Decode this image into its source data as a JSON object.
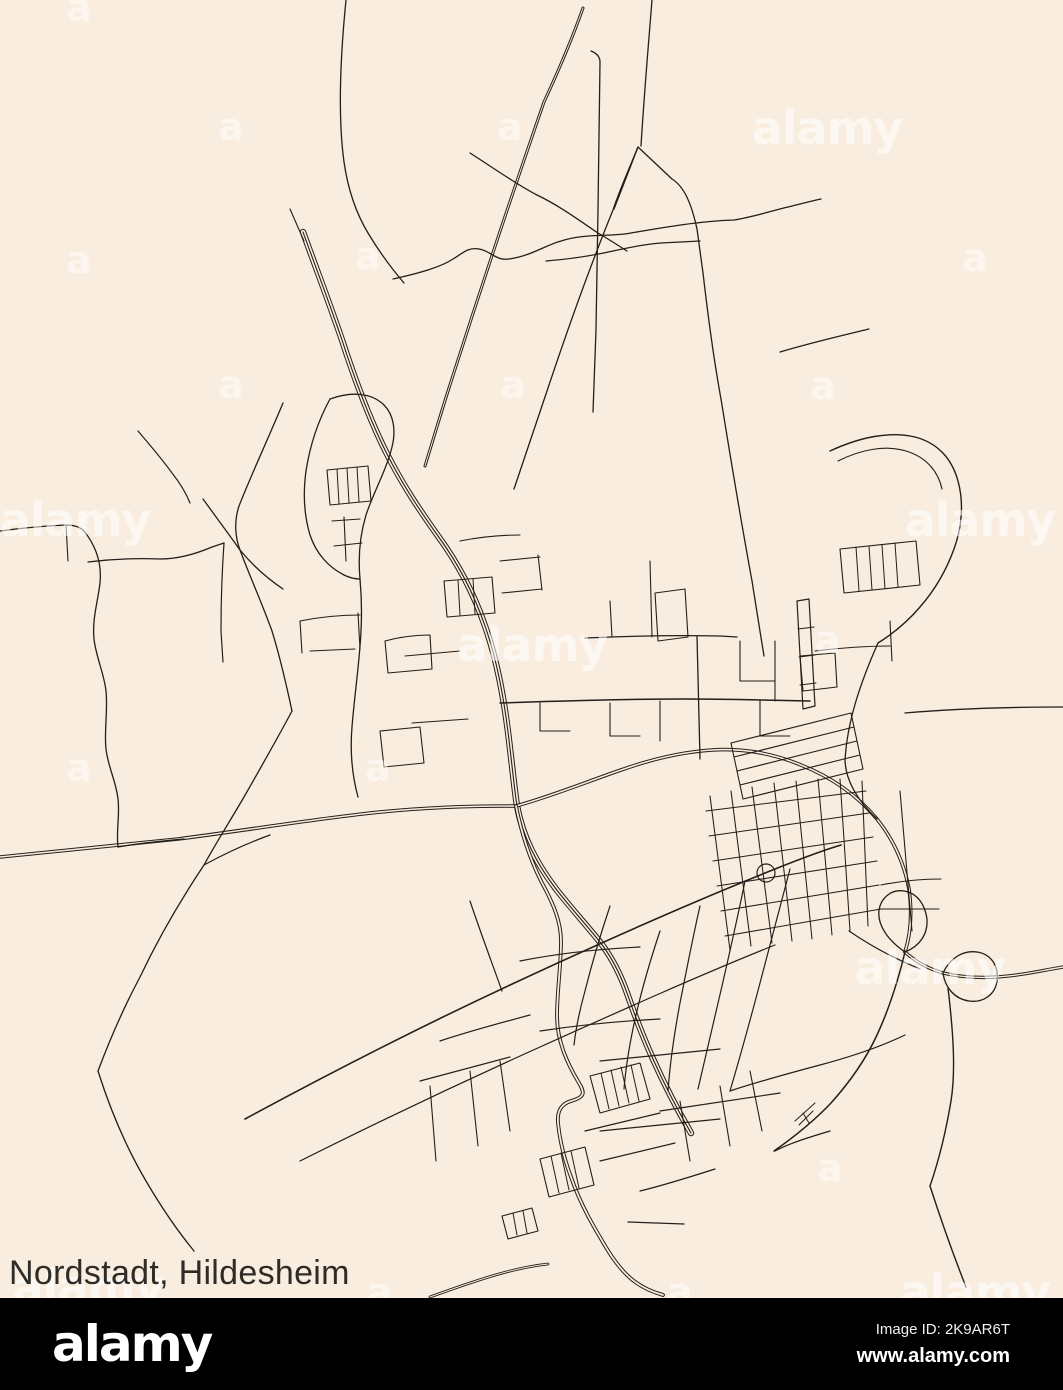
{
  "page": {
    "width": 1063,
    "height": 1390,
    "background": "#f8eddf"
  },
  "caption": {
    "text": "Nordstadt, Hildesheim"
  },
  "footer": {
    "background": "#000000",
    "logo_text": "alamy",
    "image_id": "Image ID: 2K9AR6T",
    "website": "www.alamy.com",
    "text_color": "#ffffff"
  },
  "watermarks": {
    "text": "alamy",
    "letter": "a",
    "color": "#ffffff",
    "logos": [
      {
        "x": 827,
        "y": 128
      },
      {
        "x": 75,
        "y": 520
      },
      {
        "x": 980,
        "y": 520
      },
      {
        "x": 532,
        "y": 645
      },
      {
        "x": 930,
        "y": 968
      },
      {
        "x": 88,
        "y": 1287
      },
      {
        "x": 975,
        "y": 1292
      }
    ],
    "letters": [
      {
        "x": 79,
        "y": 8
      },
      {
        "x": 231,
        "y": 127
      },
      {
        "x": 510,
        "y": 127
      },
      {
        "x": 79,
        "y": 260
      },
      {
        "x": 368,
        "y": 256
      },
      {
        "x": 231,
        "y": 385
      },
      {
        "x": 513,
        "y": 385
      },
      {
        "x": 823,
        "y": 386
      },
      {
        "x": 975,
        "y": 258
      },
      {
        "x": 79,
        "y": 768
      },
      {
        "x": 378,
        "y": 768
      },
      {
        "x": 828,
        "y": 640
      },
      {
        "x": 830,
        "y": 1168
      },
      {
        "x": 680,
        "y": 1292
      },
      {
        "x": 380,
        "y": 1292
      }
    ]
  },
  "map": {
    "title": "Nordstadt, Hildesheim road map",
    "district": "Nordstadt",
    "city": "Hildesheim",
    "road_color": "#241f1a",
    "background_color": "#f8eddf",
    "roads": [
      {
        "d": "M303,232 C316,268 329,302 342,340 C355,380 369,418 386,452 C403,486 421,512 438,536 C457,562 473,591 485,626 C495,654 503,692 508,732 C512,764 514,786 517,806 C523,838 537,864 556,889 C574,912 591,930 603,946 C613,960 621,976 627,993 C635,1016 643,1037 653,1059 C665,1086 677,1109 691,1133",
        "rail": true
      },
      {
        "d": "M0,857 C60,851 120,845 178,839 C240,831 302,821 362,814 C422,807 472,806 516,806",
        "casing": true,
        "w": 3.6
      },
      {
        "d": "M516,806 C552,796 586,782 621,770 C652,759 682,752 712,750 C742,748 772,753 801,765 C831,777 857,795 877,819 C893,839 904,863 909,889 C912,911 911,933 905,952",
        "casing": true,
        "w": 3.6
      },
      {
        "d": "M905,952 C916,962 929,969 943,973 C976,981 1011,977 1046,970 L1063,967",
        "casing": true,
        "w": 3.4
      },
      {
        "d": "M905,952 C898,981 889,1009 877,1035 C865,1061 849,1083 831,1103 C814,1121 794,1137 774,1151",
        "w": 1.5
      },
      {
        "d": "M948,988 C953,1030 956,1070 951,1101 C946,1131 939,1160 930,1186",
        "w": 1.4
      },
      {
        "d": "M930,1186 C941,1220 953,1254 966,1287",
        "w": 1.4
      },
      {
        "d": "M905,952 C889,941 877,926 879,910 C881,898 891,889 904,891 C917,893 925,904 927,919 C928,934 920,946 905,952",
        "w": 1.3
      },
      {
        "d": "M943,973 C950,958 963,950 977,952 C991,954 999,966 997,981 C995,995 983,1003 969,1001 C955,999 945,988 943,973",
        "w": 1.3
      },
      {
        "d": "M516,806 C521,831 529,857 541,881 C553,903 561,921 561,941 C561,966 557,991 557,1016 C557,1041 567,1063 579,1083 C585,1093 585,1097 571,1101 C561,1104 557,1111 558,1123 C560,1143 565,1161 571,1177 C581,1206 595,1229 607,1249 C613,1259 619,1267 627,1275 C637,1285 649,1291 663,1295",
        "casing": true,
        "w": 3.8
      },
      {
        "d": "M628,1222 L684,1224",
        "w": 1.3
      },
      {
        "d": "M430,1297 C452,1289 472,1282 492,1276 C512,1270 530,1266 548,1264",
        "casing": true,
        "w": 2.8
      },
      {
        "d": "M245,1119 C330,1073 420,1027 510,985 C600,943 690,903 775,869 C800,859 821,851 841,845",
        "w": 1.6
      },
      {
        "d": "M583,8 C570,45 557,74 544,102 C517,180 484,278 449,388 C441,413 433,440 425,466",
        "casing": true,
        "w": 3.0
      },
      {
        "d": "M591,51 C596,53 600,56 600,62 L598,210 L596,330 C595,360 594,386 593,412",
        "w": 1.3
      },
      {
        "d": "M652,0 C648,50 644,96 641,146",
        "w": 1.3
      },
      {
        "d": "M614,209 L638,147 L672,179 C685,187 692,206 697,229 L703,273 C708,316 714,361 721,399 C731,461 741,521 752,581 C756,607 760,631 764,656",
        "w": 1.3
      },
      {
        "d": "M638,147 C629,169 620,189 613,210 C589,269 567,331 547,391 C536,423 525,456 514,489",
        "w": 1.3
      },
      {
        "d": "M393,279 C420,273 441,267 453,259 C463,253 468,247 479,249 C491,251 496,261 509,259 C531,256 546,245 561,241 C586,233 611,237 631,233 C666,227 701,221 734,220 C753,217 771,211 788,207 C801,204 811,201 821,199",
        "w": 1.3
      },
      {
        "d": "M546,261 C571,259 591,256 613,251 C631,247 646,244 661,243 L700,241",
        "w": 1.2
      },
      {
        "d": "M780,352 C810,343 840,336 869,329",
        "w": 1.3
      },
      {
        "d": "M346,0 C340,60 338,118 344,162 C348,190 356,213 368,233 C380,253 392,269 404,283",
        "w": 1.3
      },
      {
        "d": "M470,153 C495,169 519,186 537,195 C560,206 580,221 598,233 C610,240 619,246 627,251",
        "w": 1.3
      },
      {
        "d": "M290,209 L304,241",
        "w": 1.1
      },
      {
        "d": "M283,403 C268,439 252,473 239,506 C234,521 235,537 240,550 C250,577 262,603 272,631 C280,657 286,683 292,711",
        "w": 1.3
      },
      {
        "d": "M203,499 C216,517 228,533 240,550 C254,567 268,579 283,589",
        "w": 1.3
      },
      {
        "d": "M88,562 C112,559 136,558 160,559 C180,559 198,553 212,547 L224,543",
        "w": 1.3
      },
      {
        "d": "M224,543 C222,571 221,601 221,631 L223,662",
        "w": 1.2
      },
      {
        "d": "M138,431 C150,445 162,459 172,473 C180,483 186,493 190,503",
        "w": 1.2
      },
      {
        "d": "M0,531 C22,528 44,526 66,525 C74,525 80,527 84,531",
        "w": 1.3
      },
      {
        "d": "M66,525 L68,561",
        "w": 1.1
      },
      {
        "d": "M84,531 C96,546 102,563 100,583 C98,601 92,619 94,639 C96,657 104,673 106,691 C108,711 104,731 106,749 C108,767 116,781 118,799 C120,815 116,831 118,847",
        "w": 1.3
      },
      {
        "d": "M118,847 C140,843 162,841 184,839",
        "w": 1.2
      },
      {
        "d": "M330,399 C352,391 372,393 384,405 C394,415 396,431 392,447 C386,471 374,491 366,515 C360,535 358,557 360,579",
        "w": 1.3
      },
      {
        "d": "M330,399 C318,421 310,445 306,471 C303,493 304,515 310,535 C316,553 328,567 344,575 C352,579 358,579 360,579",
        "w": 1.3
      },
      {
        "d": "M327,470 L368,466 L371,501 L330,505 Z",
        "w": 1.1
      },
      {
        "d": "M337,469 L339,504",
        "w": 1
      },
      {
        "d": "M347,468 L349,503",
        "w": 1
      },
      {
        "d": "M357,467 L359,502",
        "w": 1
      },
      {
        "d": "M332,521 L360,519",
        "w": 1.1
      },
      {
        "d": "M334,546 L362,543",
        "w": 1.1
      },
      {
        "d": "M344,517 L346,561",
        "w": 1.1
      },
      {
        "d": "M360,579 C362,601 362,623 360,646 C358,673 354,701 352,727 C350,751 352,775 358,797",
        "w": 1.3
      },
      {
        "d": "M292,711 C276,741 260,769 244,797 C230,821 216,843 204,865 C180,901 158,939 140,977 C124,1007 110,1039 98,1071",
        "w": 1.3
      },
      {
        "d": "M98,1071 C110,1109 126,1147 146,1181 C160,1205 176,1229 194,1251",
        "w": 1.3
      },
      {
        "d": "M204,865 C226,853 248,843 270,835",
        "w": 1.2
      },
      {
        "d": "M300,621 C320,617 340,615 360,615",
        "w": 1.1
      },
      {
        "d": "M310,651 L355,649",
        "w": 1.1
      },
      {
        "d": "M300,621 L302,653",
        "w": 1.1
      },
      {
        "d": "M358,613 L360,649",
        "w": 1.1
      },
      {
        "d": "M444,581 L492,577 L495,613 L447,617 Z",
        "w": 1.1
      },
      {
        "d": "M458,580 L460,615",
        "w": 1
      },
      {
        "d": "M473,579 L475,614",
        "w": 1
      },
      {
        "d": "M500,561 L540,557",
        "w": 1.1
      },
      {
        "d": "M502,593 L542,589",
        "w": 1.1
      },
      {
        "d": "M538,555 L542,590",
        "w": 1.1
      },
      {
        "d": "M460,541 C480,537 500,535 520,535",
        "w": 1.1
      },
      {
        "d": "M385,641 C400,637 415,635 430,635 L432,669 L388,673 Z",
        "w": 1.1
      },
      {
        "d": "M380,731 L420,727 L424,763 L384,767 Z",
        "w": 1.1
      },
      {
        "d": "M405,656 L460,651",
        "w": 1.1
      },
      {
        "d": "M412,723 L468,719",
        "w": 1.1
      },
      {
        "d": "M500,703 C560,701 620,699 680,699 C725,699 768,700 810,701",
        "w": 1.5
      },
      {
        "d": "M585,638 C630,636 675,635 720,636 L737,637",
        "w": 1.3
      },
      {
        "d": "M697,636 L700,759",
        "w": 1.3
      },
      {
        "d": "M540,703 L540,731 L570,731",
        "w": 1.1
      },
      {
        "d": "M610,703 L610,736 L640,736",
        "w": 1.1
      },
      {
        "d": "M660,701 L660,741",
        "w": 1.1
      },
      {
        "d": "M760,701 L760,736 L790,736",
        "w": 1.1
      },
      {
        "d": "M610,601 L612,637",
        "w": 1.1
      },
      {
        "d": "M650,561 L652,637",
        "w": 1.1
      },
      {
        "d": "M655,593 L685,589 L688,637 L658,641 Z",
        "w": 1.1
      },
      {
        "d": "M740,641 L740,681 L775,681",
        "w": 1.1
      },
      {
        "d": "M775,641 L775,701",
        "w": 1.1
      },
      {
        "d": "M800,656 L835,653 L837,687 L803,691 Z",
        "w": 1.1
      },
      {
        "d": "M797,601 L809,599 L815,706 L803,709 Z",
        "w": 1.2
      },
      {
        "d": "M798,629 L814,627",
        "w": 1
      },
      {
        "d": "M799,657 L815,655",
        "w": 1
      },
      {
        "d": "M800,685 L816,683",
        "w": 1
      },
      {
        "d": "M815,651 C840,648 865,646 890,646",
        "w": 1.1
      },
      {
        "d": "M890,621 L892,661",
        "w": 1.1
      },
      {
        "d": "M731,743 L851,713",
        "w": 1.1
      },
      {
        "d": "M734,757 L854,727",
        "w": 1.1
      },
      {
        "d": "M737,771 L857,741",
        "w": 1.1
      },
      {
        "d": "M740,785 L860,755",
        "w": 1.1
      },
      {
        "d": "M743,799 L863,769",
        "w": 1.1
      },
      {
        "d": "M731,743 L743,799",
        "w": 1.1
      },
      {
        "d": "M851,713 L863,769",
        "w": 1.1
      },
      {
        "d": "M710,796 L730,950",
        "w": 1.05
      },
      {
        "d": "M731,791 L751,946",
        "w": 1.05
      },
      {
        "d": "M752,787 L772,943",
        "w": 1.05
      },
      {
        "d": "M774,783 L792,941",
        "w": 1.05
      },
      {
        "d": "M796,781 L812,939",
        "w": 1.05
      },
      {
        "d": "M818,779 L832,935",
        "w": 1.05
      },
      {
        "d": "M840,779 L850,931",
        "w": 1.05
      },
      {
        "d": "M862,781 L868,926",
        "w": 1.05
      },
      {
        "d": "M706,811 L866,791",
        "w": 1.05
      },
      {
        "d": "M709,836 L869,813",
        "w": 1.05
      },
      {
        "d": "M713,861 L873,837",
        "w": 1.05
      },
      {
        "d": "M717,886 L877,861",
        "w": 1.05
      },
      {
        "d": "M721,911 L879,885",
        "w": 1.05
      },
      {
        "d": "M725,936 L881,909",
        "w": 1.05
      },
      {
        "d": "M757,873 a9,9 0 1 0 18,0 a9,9 0 1 0 -18,0",
        "w": 1.2
      },
      {
        "d": "M849,931 C871,946 895,959 920,969",
        "w": 1.2
      },
      {
        "d": "M881,885 C901,881 921,879 941,879",
        "w": 1.1
      },
      {
        "d": "M879,909 L939,909",
        "w": 1.1
      },
      {
        "d": "M900,791 L912,931",
        "w": 1.1
      },
      {
        "d": "M830,451 C860,437 890,431 915,437 C938,443 952,459 958,481 C964,503 962,527 954,549 C946,571 934,591 920,607 C908,621 894,633 878,643",
        "w": 1.4
      },
      {
        "d": "M838,461 C862,449 886,445 906,451 C926,457 938,471 942,489",
        "w": 1.1
      },
      {
        "d": "M840,549 L916,541 L920,585 L844,593 Z",
        "w": 1.1
      },
      {
        "d": "M856,547 L859,591",
        "w": 1
      },
      {
        "d": "M869,546 L872,590",
        "w": 1
      },
      {
        "d": "M882,545 L885,589",
        "w": 1
      },
      {
        "d": "M895,543 L898,587",
        "w": 1
      },
      {
        "d": "M878,643 C870,661 862,681 856,701 C850,721 846,741 845,761 C846,781 857,800 877,819",
        "w": 1.3
      },
      {
        "d": "M905,713 C950,709 1005,707 1063,707",
        "w": 1.3
      },
      {
        "d": "M470,901 C480,931 492,963 502,991",
        "w": 1.2
      },
      {
        "d": "M610,906 C600,936 592,963 585,991 C580,1009 576,1027 574,1045",
        "w": 1.2
      },
      {
        "d": "M660,931 C650,961 642,989 636,1015 C630,1041 626,1065 624,1089",
        "w": 1.2
      },
      {
        "d": "M700,906 C692,941 686,973 680,1003 C674,1035 670,1063 668,1091",
        "w": 1.2
      },
      {
        "d": "M745,881 C738,916 730,951 722,986 C714,1021 706,1056 698,1089",
        "w": 1.2
      },
      {
        "d": "M790,869 C780,906 770,946 760,983 C750,1021 740,1057 730,1091",
        "w": 1.2
      },
      {
        "d": "M520,961 C560,953 600,949 640,947",
        "w": 1.2
      },
      {
        "d": "M540,1031 C580,1025 620,1021 660,1019",
        "w": 1.2
      },
      {
        "d": "M600,1061 C640,1057 680,1053 720,1049",
        "w": 1.2
      },
      {
        "d": "M660,1111 C700,1105 740,1099 780,1093",
        "w": 1.2
      },
      {
        "d": "M600,1131 C640,1127 680,1123 720,1119",
        "w": 1.2
      },
      {
        "d": "M730,1091 C760,1081 790,1073 820,1065 C850,1057 880,1047 905,1035",
        "w": 1.2
      },
      {
        "d": "M775,1151 C790,1143 810,1137 830,1131",
        "w": 1.2
      },
      {
        "d": "M300,1161 C380,1121 460,1083 540,1047 C620,1011 700,975 775,945",
        "w": 1.2
      },
      {
        "d": "M440,1041 C470,1031 500,1023 530,1015",
        "w": 1.2
      },
      {
        "d": "M420,1081 C450,1073 480,1065 510,1057",
        "w": 1.2
      },
      {
        "d": "M430,1086 L436,1161",
        "w": 1.1
      },
      {
        "d": "M470,1071 L478,1146",
        "w": 1.1
      },
      {
        "d": "M500,1061 L510,1131",
        "w": 1.1
      },
      {
        "d": "M590,1076 L640,1063 L650,1099 L600,1113 Z",
        "w": 1.1
      },
      {
        "d": "M601,1073 L609,1109",
        "w": 1
      },
      {
        "d": "M611,1070 L619,1106",
        "w": 1
      },
      {
        "d": "M621,1067 L629,1103",
        "w": 1
      },
      {
        "d": "M631,1065 L639,1101",
        "w": 1
      },
      {
        "d": "M540,1159 L585,1147 L594,1185 L549,1197 Z",
        "w": 1.1
      },
      {
        "d": "M551,1156 L559,1193",
        "w": 1
      },
      {
        "d": "M561,1153 L569,1190",
        "w": 1
      },
      {
        "d": "M571,1151 L579,1188",
        "w": 1
      },
      {
        "d": "M502,1216 L532,1208 L538,1231 L508,1239 Z",
        "w": 1.1
      },
      {
        "d": "M513,1213 L517,1235",
        "w": 1
      },
      {
        "d": "M523,1211 L527,1233",
        "w": 1
      },
      {
        "d": "M585,1131 C610,1125 635,1119 660,1113",
        "w": 1.2
      },
      {
        "d": "M600,1161 C625,1155 650,1149 675,1143",
        "w": 1.2
      },
      {
        "d": "M640,1191 C665,1185 690,1177 715,1169",
        "w": 1.2
      },
      {
        "d": "M680,1101 L690,1161",
        "w": 1.1
      },
      {
        "d": "M720,1086 L730,1146",
        "w": 1.1
      },
      {
        "d": "M750,1071 L762,1131",
        "w": 1.1
      },
      {
        "d": "M795,1121 L815,1103",
        "w": 1
      },
      {
        "d": "M799,1125 L813,1111",
        "w": 1
      },
      {
        "d": "M803,1113 L809,1123",
        "w": 1
      }
    ]
  }
}
